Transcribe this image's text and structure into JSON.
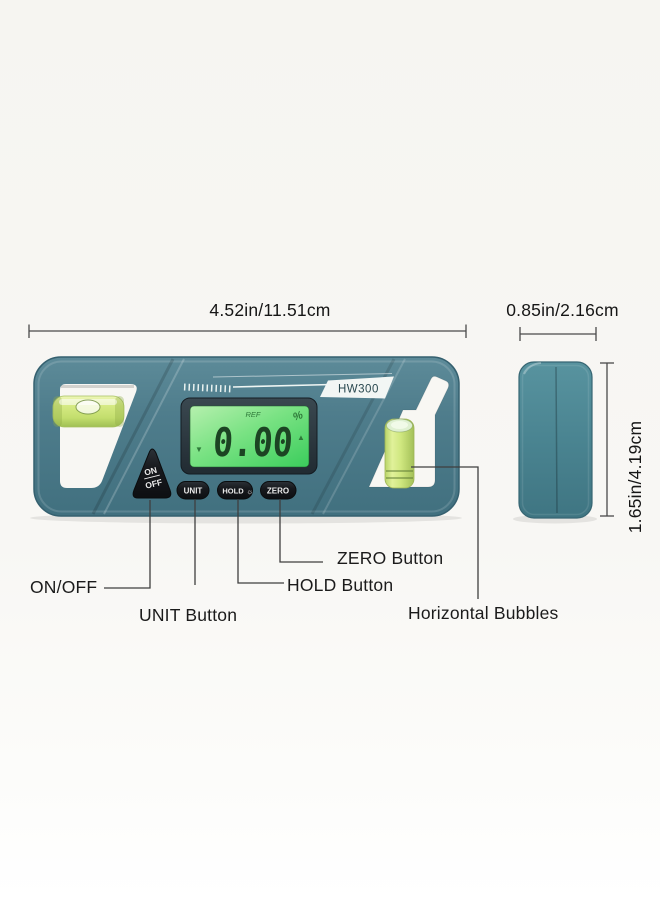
{
  "dimensions": {
    "width_label": "4.52in/11.51cm",
    "side_width_label": "0.85in/2.16cm",
    "height_label": "1.65in/4.19cm"
  },
  "device": {
    "model": "HW300",
    "screen": {
      "ref_indicator": "REF",
      "percent_indicator": "%",
      "reading": "0.00",
      "down_arrow": "▼",
      "up_arrow": "▲"
    },
    "buttons": {
      "power_top": "ON",
      "power_bottom": "OFF",
      "unit": "UNIT",
      "hold": "HOLD",
      "hold_backlight_icon": "☼",
      "zero": "ZERO"
    }
  },
  "callouts": {
    "power": "ON/OFF",
    "unit": "UNIT Button",
    "hold": "HOLD Button",
    "zero": "ZERO Button",
    "bubbles": "Horizontal Bubbles"
  },
  "colors": {
    "body_teal": "#4e7c8b",
    "screen_green": "#56d96e",
    "vial_green": "#cde77c",
    "button_black": "#17191d",
    "lcd_digit_green": "#1c4423",
    "annotation_text": "#1b1b1b"
  }
}
